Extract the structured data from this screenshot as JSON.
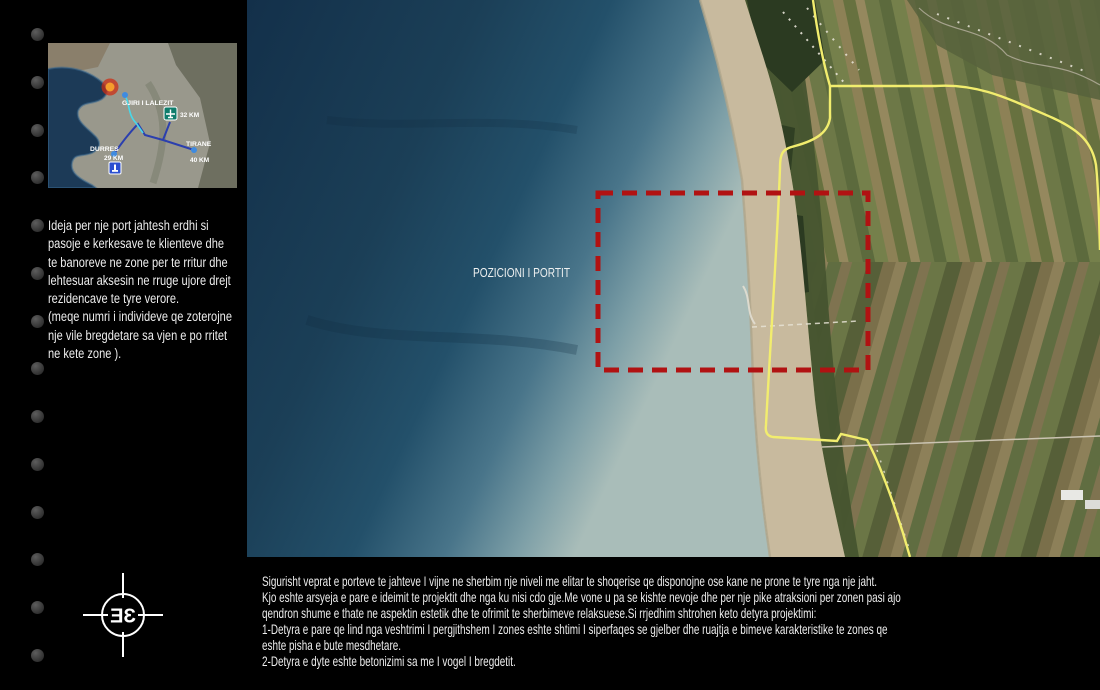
{
  "sidebar": {
    "screw_count": 14
  },
  "minimap": {
    "gjiri_label": "GJIRI I LALEZIT",
    "airport_distance": "32 KM",
    "tirane_label": "TIRANE",
    "tirane_distance": "40 KM",
    "durres_label": "DURRES",
    "durres_distance": "29 KM"
  },
  "intro": {
    "lines": [
      "Ideja per nje port jahtesh erdhi  si",
      "pasoje e kerkesave te klienteve dhe",
      "te banoreve ne zone per te rritur dhe",
      "lehtesuar aksesin ne rruge ujore drejt",
      "rezidencave te  tyre verore.",
      "(meqe numri i individeve qe zoterojne",
      "nje vile bregdetare sa vjen e po rritet",
      "ne kete zone )."
    ]
  },
  "satellite": {
    "area_label": "POZICIONI I PORTIT"
  },
  "description": {
    "lines": [
      "Sigurisht veprat e porteve te jahteve I vijne ne sherbim nje niveli me elitar te shoqerise qe disponojne ose kane ne prone te tyre nga nje jaht.",
      "Kjo eshte arsyeja e pare e ideimit te projektit dhe nga ku nisi cdo gje.Me vone u pa se kishte nevoje dhe per nje pike atraksioni per zonen pasi ajo",
      "qendron shume e thate ne aspektin estetik dhe te ofrimit te sherbimeve relaksuese.Si rrjedhim shtrohen keto detyra projektimi:",
      "1-Detyra e pare qe lind nga veshtrimi I pergjithshem I zones eshte shtimi I siperfaqes se gjelber dhe ruajtja e bimeve karakteristike te zones qe",
      "eshte pisha e bute mesdhetare.",
      "2-Detyra e dyte eshte betonizimi sa me I vogel I bregdetit."
    ]
  },
  "logo": {
    "monogram": "ƎƐ"
  },
  "colors": {
    "highlight_red": "#b11212",
    "road_yellow": "#f2ed6e",
    "route_blue": "#2b3fae",
    "route_cyan": "#49d7e8",
    "sea_deep": "#13304a",
    "sea_shallow": "#a9bdb9"
  }
}
